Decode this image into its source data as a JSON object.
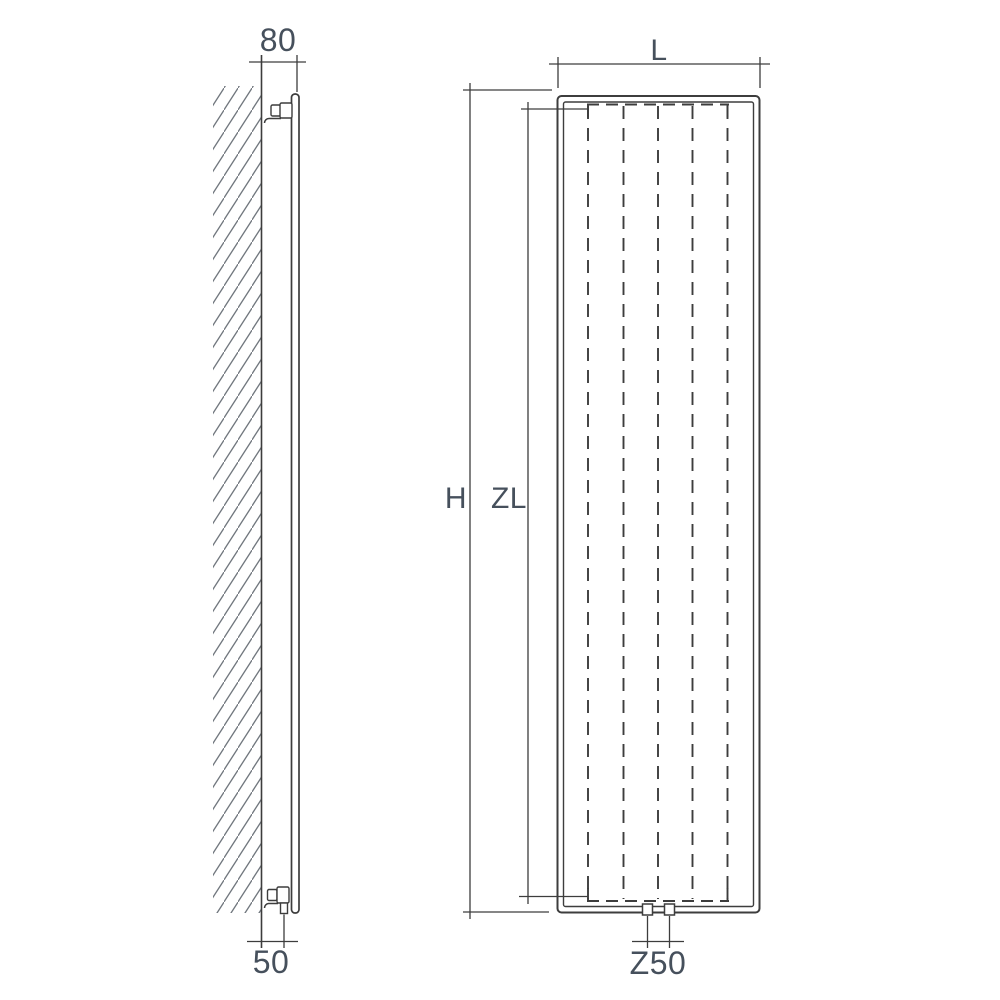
{
  "drawing": {
    "side_view": {
      "depth_label": "80",
      "bottom_offset_label": "50"
    },
    "front_view": {
      "width_label": "L",
      "height_label": "H",
      "inner_height_label": "ZL",
      "connection_spacing_label": "Z50"
    },
    "colors": {
      "line": "#3d3d3d",
      "text": "#46505c",
      "hatch": "#70767d",
      "background": "#ffffff"
    }
  }
}
